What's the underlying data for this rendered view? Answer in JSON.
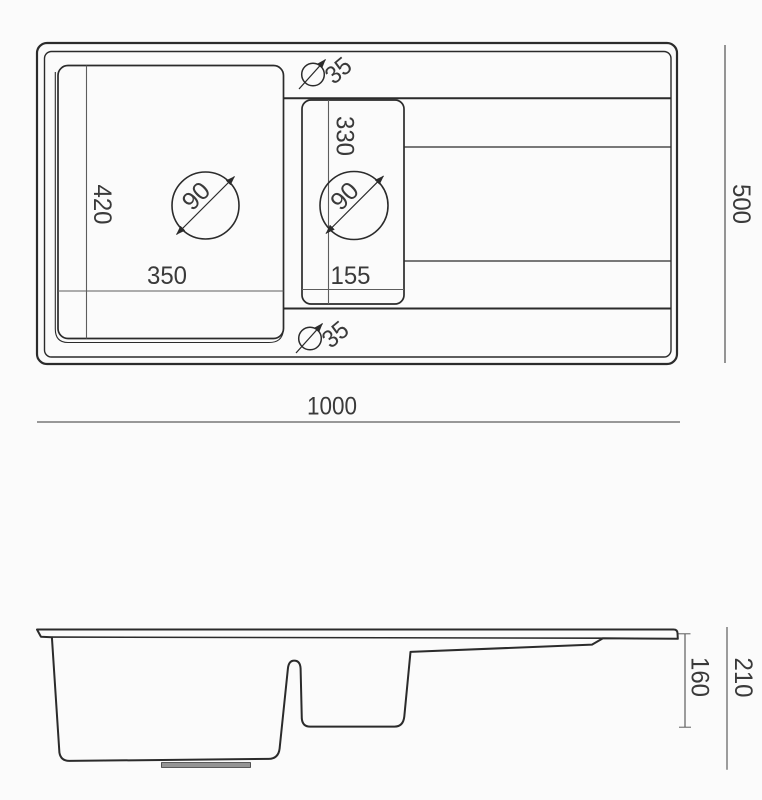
{
  "title": "Kitchen sink technical dimension drawing",
  "colors": {
    "line": "#2b2b2b",
    "dimension_line": "#5d5d5d",
    "text": "#3a3a3a",
    "background": "#fbfbfb",
    "drain_fill": "#949494"
  },
  "top_view": {
    "overall_width": "1000",
    "overall_height": "500",
    "main_bowl": {
      "width": "350",
      "depth": "420",
      "drain_diameter": "90"
    },
    "second_bowl": {
      "width": "155",
      "depth": "330",
      "drain_diameter": "90"
    },
    "faucet_hole_top": {
      "diameter": "35"
    },
    "faucet_hole_bottom": {
      "diameter": "35"
    }
  },
  "side_view": {
    "bowl_depth": "160",
    "overall_depth": "210"
  }
}
